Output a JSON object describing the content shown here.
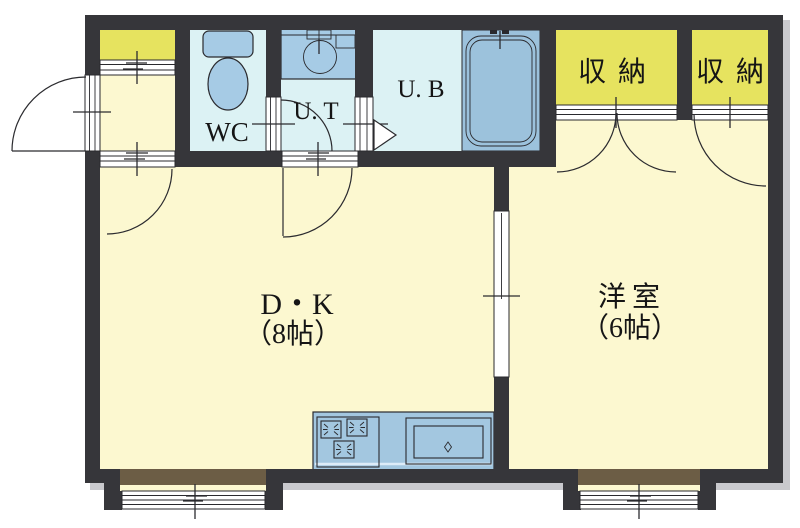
{
  "plan": {
    "rooms": {
      "wc": {
        "label": "WC"
      },
      "utility": {
        "label": "U. T"
      },
      "bath": {
        "label": "U. B"
      },
      "storage_left": {
        "label": "収納"
      },
      "storage_right": {
        "label": "収納"
      },
      "dining_kitchen": {
        "label": "D・K",
        "size": "（8帖）"
      },
      "western_room": {
        "label": "洋室",
        "size": "（6帖）"
      }
    },
    "colors": {
      "wall": "#36363a",
      "room_floor": "#fcf8d0",
      "wet_area_floor": "#dcf2f4",
      "closet_floor": "#e6e35f",
      "fixture_blue": "#a6cbe5",
      "bathtub_blue": "#9cc2dc",
      "bay_window_sill_brown": "#6c5d45",
      "line": "#2a2a2e"
    }
  }
}
